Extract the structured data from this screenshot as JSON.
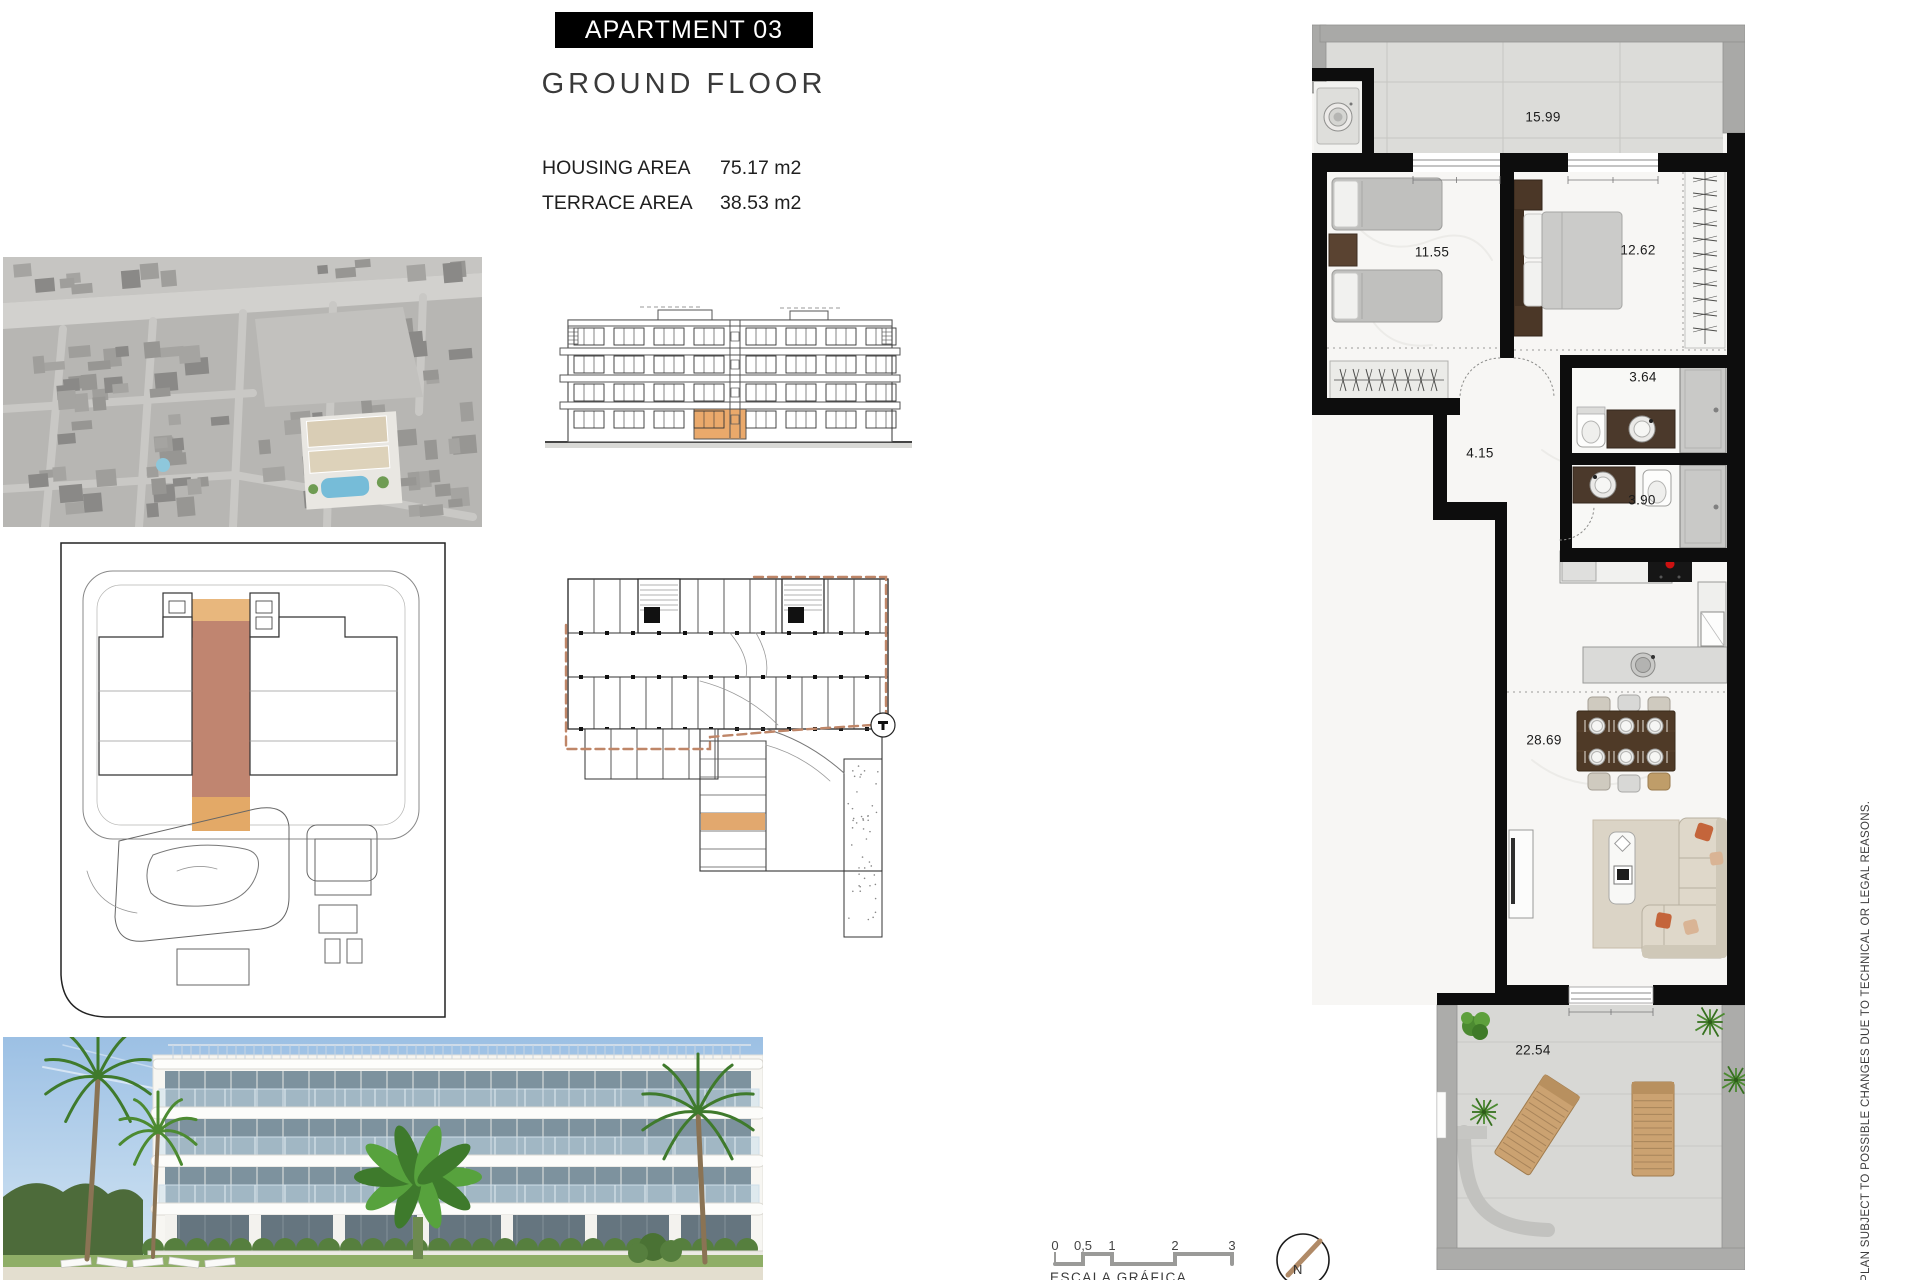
{
  "header": {
    "title": "APARTMENT 03",
    "subtitle": "GROUND FLOOR",
    "areas": [
      {
        "label": "HOUSING AREA",
        "value": "75.17 m2"
      },
      {
        "label": "TERRACE AREA",
        "value": "38.53 m2"
      }
    ]
  },
  "floor_plan": {
    "rooms": [
      {
        "name": "terrace-top",
        "area": "15.99"
      },
      {
        "name": "bedroom-1",
        "area": "11.55"
      },
      {
        "name": "bedroom-2",
        "area": "12.62"
      },
      {
        "name": "bathroom-1",
        "area": "3.64"
      },
      {
        "name": "hallway",
        "area": "4.15"
      },
      {
        "name": "bathroom-2",
        "area": "3.90"
      },
      {
        "name": "living-kitchen",
        "area": "28.69"
      },
      {
        "name": "terrace-bottom",
        "area": "22.54"
      }
    ]
  },
  "scale_bar": {
    "labels": [
      "0",
      "0,5",
      "1",
      "2",
      "3"
    ],
    "caption": "ESCALA GRÁFICA"
  },
  "compass": {
    "label": "N"
  },
  "disclaimer": "PLAN SUBJECT TO POSSIBLE CHANGES DUE TO TECHNICAL OR LEGAL REASONS.",
  "colors": {
    "wall": "#0D0D0D",
    "terrace_wall": "#A9A9A7",
    "highlight_orange": "#E8A96B",
    "highlight_brown": "#C08570",
    "highlight_tan": "#E3B57F",
    "hob_red": "#CC1111",
    "dashed_outline": "#BF8668"
  }
}
